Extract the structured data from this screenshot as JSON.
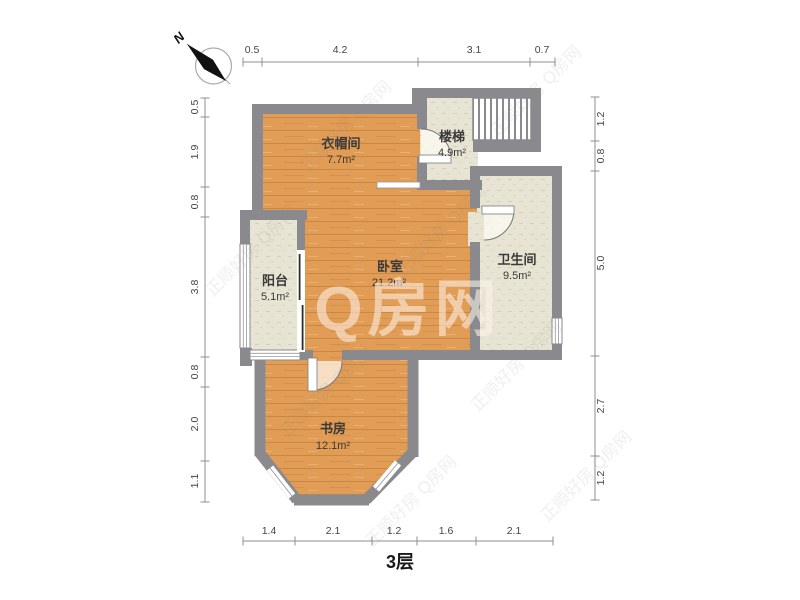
{
  "meta": {
    "floor_label": "3层"
  },
  "compass": {
    "north_label": "N"
  },
  "watermark": {
    "main": "Q房网",
    "tile": "正顺好房 Q房网"
  },
  "rooms": [
    {
      "id": "cloakroom",
      "name": "衣帽间",
      "area": "7.7m²"
    },
    {
      "id": "stairs",
      "name": "楼梯",
      "area": "4.9m²"
    },
    {
      "id": "bedroom",
      "name": "卧室",
      "area": "21.2m²"
    },
    {
      "id": "bathroom",
      "name": "卫生间",
      "area": "9.5m²"
    },
    {
      "id": "balcony",
      "name": "阳台",
      "area": "5.1m²"
    },
    {
      "id": "study",
      "name": "书房",
      "area": "12.1m²"
    }
  ],
  "dimensions": {
    "top": [
      "0.5",
      "4.2",
      "3.1",
      "0.7"
    ],
    "bottom": [
      "1.4",
      "2.1",
      "1.2",
      "1.6",
      "2.1"
    ],
    "left": [
      "0.5",
      "1.9",
      "0.8",
      "3.8",
      "0.8",
      "2.0",
      "1.1"
    ],
    "right": [
      "1.2",
      "0.8",
      "5.0",
      "2.7",
      "1.2"
    ]
  },
  "colors": {
    "wall": "#8a8a8e",
    "wood_floor": "#e19c55",
    "tile_floor": "#e8e4d3"
  }
}
